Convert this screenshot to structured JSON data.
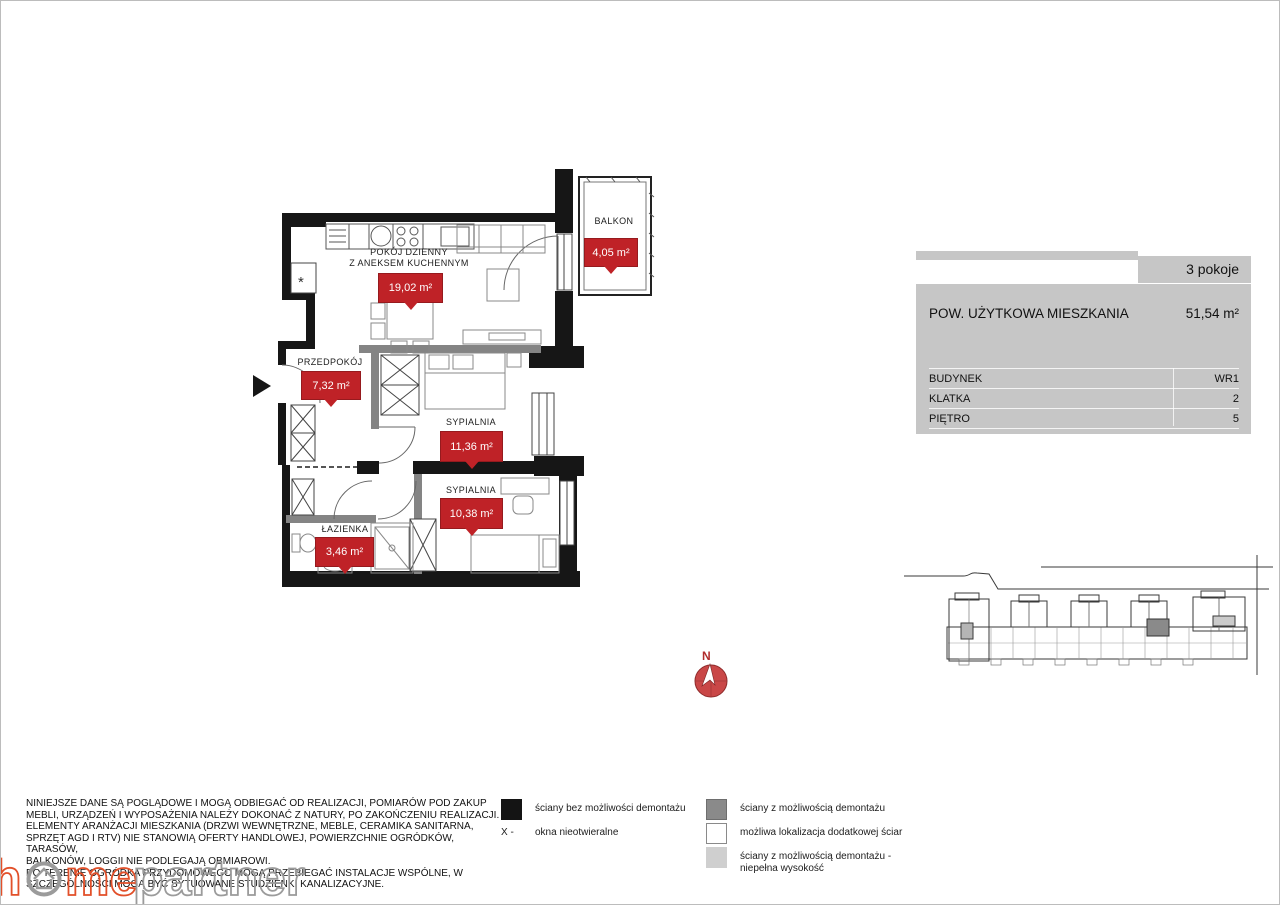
{
  "floorplan": {
    "shaft_symbol": "*",
    "compass_north": "N",
    "rooms": [
      {
        "name": "POKÓJ DZIENNY\nZ ANEKSEM KUCHENNYM",
        "area": "19,02 m²"
      },
      {
        "name": "BALKON",
        "area": "4,05 m²"
      },
      {
        "name": "PRZEDPOKÓJ",
        "area": "7,32 m²"
      },
      {
        "name": "SYPIALNIA",
        "area": "11,36 m²"
      },
      {
        "name": "SYPIALNIA",
        "area": "10,38 m²"
      },
      {
        "name": "ŁAZIENKA",
        "area": "3,46 m²"
      }
    ]
  },
  "info_panel": {
    "rooms_count": "3 pokoje",
    "area_label": "POW. UŻYTKOWA MIESZKANIA",
    "area_value": "51,54 m²",
    "rows": [
      {
        "label": "BUDYNEK",
        "value": "WR1"
      },
      {
        "label": "KLATKA",
        "value": "2"
      },
      {
        "label": "PIĘTRO",
        "value": "5"
      }
    ]
  },
  "legend": {
    "wall_fixed": "ściany bez możliwości demontażu",
    "windows_prefix": "X -",
    "windows_fixed": "okna nieotwieralne",
    "wall_removable": "ściany z możliwością demontażu",
    "wall_possible": "możliwa lokalizacja dodatkowej ściar",
    "wall_low": "ściany z możliwością demontażu -\nniepełna wysokość"
  },
  "disclaimer": "NINIEJSZE DANE SĄ POGLĄDOWE I MOGĄ ODBIEGAĆ OD REALIZACJI, POMIARÓW POD ZAKUP\nMEBLI, URZĄDZEŃ I WYPOSAŻENIA NALEŻY DOKONAĆ Z NATURY, PO ZAKOŃCZENIU REALIZACJI.\nELEMENTY ARANŻACJI MIESZKANIA (DRZWI WEWNĘTRZNE, MEBLE, CERAMIKA SANITARNA,\nSPRZĘT AGD I RTV) NIE STANOWIĄ OFERTY HANDLOWEJ, POWIERZCHNIE OGRÓDKÓW, TARASÓW,\nBALKONÓW, LOGGII NIE PODLEGAJĄ OBMIAROWI.\nPO TERENIE OGRÓDKA PRZYDOMOWEGO MOGĄ PRZEBIEGAĆ INSTALACJE WSPÓLNE, W\nSZCZEGÓLNOŚCI MOGĄ BYĆ SYTUOWANE STUDZIENKI KANALIZACYJNE.",
  "logo": {
    "h": "h",
    "me": "me",
    "partner": "partner"
  },
  "colors": {
    "area_badge": "#bf2227",
    "wall": "#161616",
    "wall_removable": "#848484",
    "wall_low": "#cfcfcf",
    "panel_bg": "#c6c6c6",
    "logo_orange": "#e2502a",
    "logo_gray": "#9b9b9b"
  }
}
